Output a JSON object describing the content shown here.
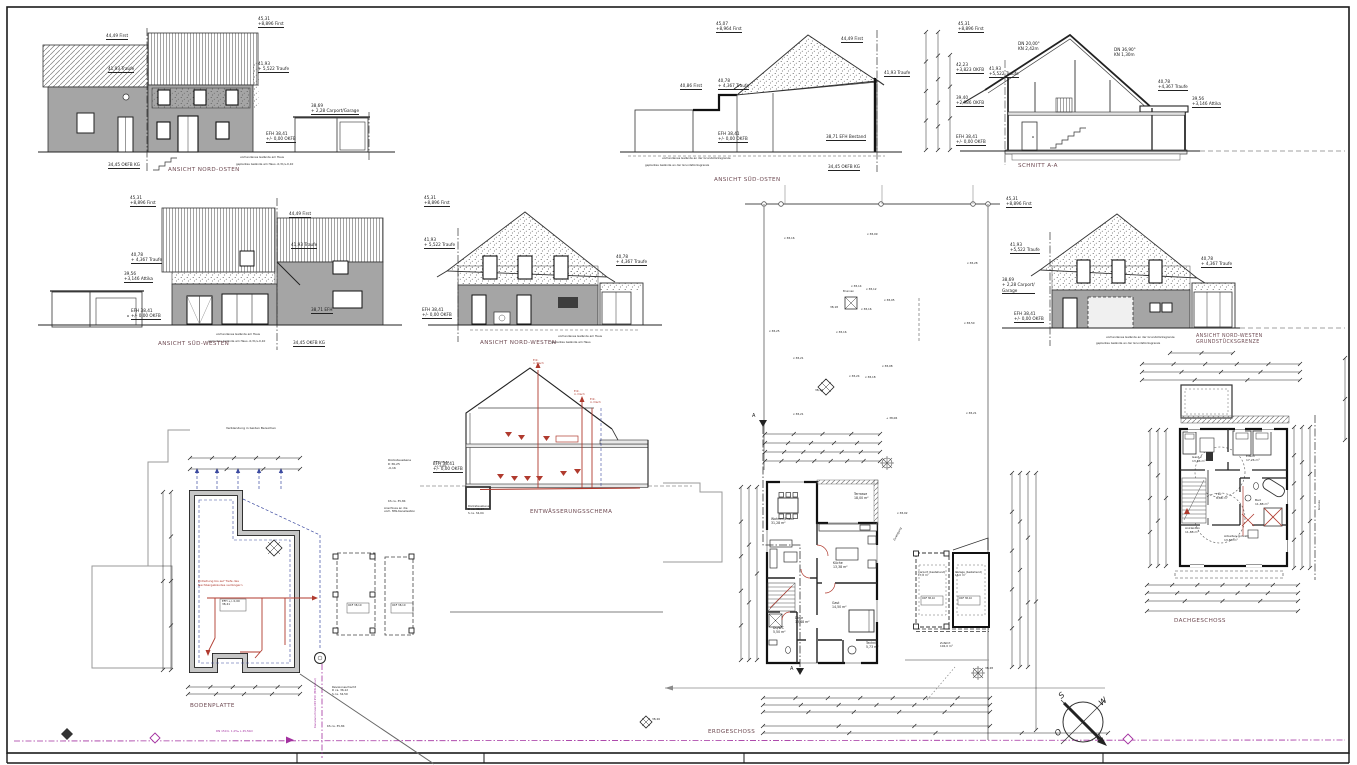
{
  "document": {
    "kind": "architectural-sheet",
    "language": "de"
  },
  "colors": {
    "wall_gray": "#a5a5a5",
    "line": "#222222",
    "drainage_red": "#b03a2e",
    "utility_magenta": "#a331a0",
    "guide_blue": "#3c4aa0",
    "boundary_gray": "#9a9a9a",
    "title_maroon": "#6e4a52"
  },
  "compass": {
    "s_label": "S",
    "w_label": "W",
    "o_label": "O",
    "n_label": "N"
  },
  "drawings": {
    "nord_osten": {
      "title": "ANSICHT NORD-OSTEN",
      "labels": [
        {
          "t": "44,49 First",
          "x": 106,
          "y": 33,
          "lv": 1
        },
        {
          "t": "41,93 Traufe",
          "x": 108,
          "y": 66,
          "lv": 1
        },
        {
          "t": "45,31\n+8,896 First",
          "x": 258,
          "y": 16,
          "lv": 1
        },
        {
          "t": "41,93\n+ 5,522 Traufe",
          "x": 258,
          "y": 61,
          "lv": 1
        },
        {
          "t": "38,69\n+ 2,28 Carport/Garage",
          "x": 311,
          "y": 103,
          "lv": 1
        },
        {
          "t": "EFH 38,41\n+/- 0,00 OKFB",
          "x": 266,
          "y": 131,
          "lv": 1
        },
        {
          "t": "34,45 OKFB KG",
          "x": 108,
          "y": 162,
          "lv": 1
        },
        {
          "t": "vorhandenes Gelände am Haus",
          "x": 240,
          "y": 156,
          "s": 2.8
        },
        {
          "t": "geplantes Gelände am Haus -0,31/+0,10",
          "x": 236,
          "y": 163,
          "s": 2.8
        }
      ]
    },
    "sued_osten": {
      "title": "ANSICHT SÜD-OSTEN",
      "labels": [
        {
          "t": "45,07\n+8,964 First",
          "x": 716,
          "y": 21,
          "lv": 1
        },
        {
          "t": "44,49 First",
          "x": 841,
          "y": 36,
          "lv": 1
        },
        {
          "t": "41,93 Traufe",
          "x": 884,
          "y": 70,
          "lv": 1
        },
        {
          "t": "40,86 First",
          "x": 680,
          "y": 83,
          "lv": 1
        },
        {
          "t": "40,78\n+ 4,367 Traufe",
          "x": 718,
          "y": 78,
          "lv": 1
        },
        {
          "t": "EFH 38,41\n+/- 0,00 OKFB",
          "x": 718,
          "y": 131,
          "lv": 1
        },
        {
          "t": "38,71 EFH Bestand",
          "x": 826,
          "y": 134,
          "lv": 1
        },
        {
          "t": "34,45 OKFB KG",
          "x": 828,
          "y": 164,
          "lv": 1
        },
        {
          "t": "vorhandenes Gelände an der Grundstücksgrenze",
          "x": 662,
          "y": 157,
          "s": 2.8
        },
        {
          "t": "geplantes Gelände an der Grundstücksgrenze",
          "x": 645,
          "y": 164,
          "s": 2.8
        }
      ]
    },
    "schnitt": {
      "title": "SCHNITT A-A",
      "labels": [
        {
          "t": "45,31\n+8,896 First",
          "x": 958,
          "y": 21,
          "lv": 1
        },
        {
          "t": "DN 20,00°\nKN 2,42m",
          "x": 1018,
          "y": 41
        },
        {
          "t": "DN 36,90°\nKN 1,30m",
          "x": 1114,
          "y": 47
        },
        {
          "t": "42,23\n+3,823 OKFB",
          "x": 956,
          "y": 62,
          "lv": 1
        },
        {
          "t": "41,93\n+5,522 Traufe",
          "x": 989,
          "y": 66,
          "lv": 1
        },
        {
          "t": "40,78\n+4,367 Traufe",
          "x": 1158,
          "y": 79,
          "lv": 1
        },
        {
          "t": "39,40\n+2,986 OKFB",
          "x": 956,
          "y": 95,
          "lv": 1
        },
        {
          "t": "39,56\n+3,146 Attika",
          "x": 1192,
          "y": 96,
          "lv": 1
        },
        {
          "t": "EFH 38,41\n+/- 0,00 OKFB",
          "x": 956,
          "y": 134,
          "lv": 1
        }
      ]
    },
    "sued_westen": {
      "title": "ANSICHT SÜD-WESTEN",
      "labels": [
        {
          "t": "45,31\n+8,896 First",
          "x": 130,
          "y": 195,
          "lv": 1
        },
        {
          "t": "44,49 First",
          "x": 289,
          "y": 211,
          "lv": 1
        },
        {
          "t": "41,93 Traufe",
          "x": 291,
          "y": 242,
          "lv": 1
        },
        {
          "t": "40,78\n+ 4,367 Traufe",
          "x": 131,
          "y": 252,
          "lv": 1
        },
        {
          "t": "39,56\n+3,146 Attika",
          "x": 124,
          "y": 271,
          "lv": 1
        },
        {
          "t": "EFH 38,41\n+/- 0,00 OKFB",
          "x": 131,
          "y": 308,
          "lv": 1
        },
        {
          "t": "38,71 EFH",
          "x": 311,
          "y": 307,
          "lv": 1
        },
        {
          "t": "34,45 OKFB KG",
          "x": 293,
          "y": 340,
          "lv": 1
        },
        {
          "t": "vorhandenes Gelände am Haus",
          "x": 216,
          "y": 333,
          "s": 2.8
        },
        {
          "t": "geplantes Gelände am Haus -0,31/+0,10",
          "x": 208,
          "y": 340,
          "s": 2.8
        }
      ]
    },
    "nord_westen": {
      "title": "ANSICHT NORD-WESTEN",
      "labels": [
        {
          "t": "45,31\n+8,896 First",
          "x": 424,
          "y": 195,
          "lv": 1
        },
        {
          "t": "41,93\n+ 5,522 Traufe",
          "x": 424,
          "y": 237,
          "lv": 1
        },
        {
          "t": "40,78\n+ 4,367 Traufe",
          "x": 616,
          "y": 254,
          "lv": 1
        },
        {
          "t": "EFH 38,41\n+/- 0,00 OKFB",
          "x": 422,
          "y": 307,
          "lv": 1
        },
        {
          "t": "vorhandenes Gelände am Haus",
          "x": 558,
          "y": 335,
          "s": 2.8
        },
        {
          "t": "geplantes Gelände am Haus",
          "x": 551,
          "y": 341,
          "s": 2.8
        }
      ]
    },
    "nord_westen_grenze": {
      "title": "ANSICHT NORD-WESTEN\nGRUNDSTÜCKSGRENZE",
      "labels": [
        {
          "t": "45,31\n+8,896 First",
          "x": 1006,
          "y": 196,
          "lv": 1
        },
        {
          "t": "41,93\n+5,522 Traufe",
          "x": 1010,
          "y": 242,
          "lv": 1
        },
        {
          "t": "38,69\n+ 2,28 Carport/\nGarage",
          "x": 1002,
          "y": 277,
          "lv": 1
        },
        {
          "t": "EFH 38,41\n+/- 0,00 OKFB",
          "x": 1014,
          "y": 311,
          "lv": 1
        },
        {
          "t": "40,78\n+ 4,367 Traufe",
          "x": 1201,
          "y": 256,
          "lv": 1
        },
        {
          "t": "vorhandenes Gelände an der Grundstücksgrenze",
          "x": 1106,
          "y": 336,
          "s": 2.8
        },
        {
          "t": "geplantes Gelände an der Grundstücksgrenze",
          "x": 1096,
          "y": 342,
          "s": 2.8
        }
      ]
    },
    "bodenplatte": {
      "title": "BODENPLATTE",
      "labels": [
        {
          "t": "Verblendung in beiden Bereichen",
          "x": 226,
          "y": 427,
          "s": 3
        },
        {
          "t": "Rückstauebene\nD 36,25\n-0,16",
          "x": 388,
          "y": 459,
          "s": 3
        },
        {
          "t": "EFH 38,41\n+/- 0,00",
          "x": 434,
          "y": 461,
          "s": 3
        },
        {
          "t": "KS ca. 35,84",
          "x": 388,
          "y": 500,
          "s": 2.8
        },
        {
          "t": "Anschluss an die\nvorh. MW-Kanalisation",
          "x": 384,
          "y": 507,
          "s": 2.8
        },
        {
          "t": "Erdleitung bis auf Tiefe des\nNachbargebäudes verlängern",
          "x": 198,
          "y": 580,
          "s": 3,
          "c": "red"
        },
        {
          "t": "EFH +/- 0,00\n38,41",
          "x": 222,
          "y": 600,
          "s": 2.8
        },
        {
          "t": "OKF 38,10",
          "x": 348,
          "y": 604,
          "s": 2.6
        },
        {
          "t": "OKF 38,10",
          "x": 392,
          "y": 604,
          "s": 2.6
        },
        {
          "t": "Revisionsschacht\nD ca. 36,12\nS ca. 34,59",
          "x": 332,
          "y": 686,
          "s": 2.8
        },
        {
          "t": "DN 150 b. 1,0‰ L 45,50m",
          "x": 216,
          "y": 730,
          "s": 2.8,
          "c": "mag"
        },
        {
          "t": "KS ca. 35,84",
          "x": 327,
          "y": 725,
          "s": 2.8
        },
        {
          "t": "Kanalanschluss DN 150 (MW-Kanal)",
          "x": 314,
          "y": 728,
          "s": 2.8,
          "c": "mag",
          "r": -90
        }
      ]
    },
    "entwaesserung": {
      "title": "ENTWÄSSERUNGSSCHEMA",
      "labels": [
        {
          "t": "EFH 38,41\n+/- 0,00 OKFB",
          "x": 433,
          "y": 461,
          "lv": 1
        },
        {
          "t": "Ent.\nü. Dach",
          "x": 533,
          "y": 359,
          "s": 2.8,
          "c": "red"
        },
        {
          "t": "Ent.\nü. Dach",
          "x": 574,
          "y": 390,
          "s": 2.8,
          "c": "red"
        },
        {
          "t": "Ent.\nü. Dach",
          "x": 590,
          "y": 398,
          "s": 2.8,
          "c": "red"
        },
        {
          "t": "Rückstauebene\nD ca. 36,17\nS ca. 34,04",
          "x": 468,
          "y": 505,
          "s": 2.8
        }
      ]
    },
    "erdgeschoss": {
      "title": "ERDGESCHOSS",
      "labels": [
        {
          "t": "Wohnen/Essen\n31,28 m²",
          "x": 771,
          "y": 517,
          "s": 3.2
        },
        {
          "t": "Terrasse\n18,00 m²",
          "x": 854,
          "y": 492,
          "s": 3.2
        },
        {
          "t": "Küche\n13,38 m²",
          "x": 833,
          "y": 561,
          "s": 3.2
        },
        {
          "t": "Gast\n14,50 m²",
          "x": 832,
          "y": 601,
          "s": 3.2
        },
        {
          "t": "Diele\n13,48 m²",
          "x": 795,
          "y": 616,
          "s": 3.2
        },
        {
          "t": "Du/WC\n5,50 m²",
          "x": 773,
          "y": 626,
          "s": 3.2
        },
        {
          "t": "Technik\n5,73 m²",
          "x": 866,
          "y": 641,
          "s": 3.2
        },
        {
          "t": "Zuwegung",
          "x": 893,
          "y": 540,
          "s": 2.8,
          "r": -62
        },
        {
          "t": "Carport (bestehend)\n17,8 m²",
          "x": 918,
          "y": 571,
          "s": 2.7
        },
        {
          "t": "Garage (bestehend)\n18,0 m²",
          "x": 955,
          "y": 571,
          "s": 2.7
        },
        {
          "t": "OKF 38,10",
          "x": 922,
          "y": 597,
          "s": 2.5
        },
        {
          "t": "OKF 38,10",
          "x": 959,
          "y": 597,
          "s": 2.5
        },
        {
          "t": "Zufahrt\n102,0 m²",
          "x": 940,
          "y": 642,
          "s": 2.8
        },
        {
          "t": "A",
          "x": 790,
          "y": 666,
          "s": 5
        },
        {
          "t": "A",
          "x": 752,
          "y": 413,
          "s": 5
        }
      ]
    },
    "dachgeschoss": {
      "title": "DACHGESCHOSS",
      "labels": [
        {
          "t": "Gast 2\n13,86 m²",
          "x": 1192,
          "y": 456,
          "s": 3
        },
        {
          "t": "Eltern\n17,26 m²",
          "x": 1246,
          "y": 455,
          "s": 3
        },
        {
          "t": "Flur\n8,86 m²",
          "x": 1216,
          "y": 493,
          "s": 3
        },
        {
          "t": "Bad\n11,88 m²",
          "x": 1255,
          "y": 499,
          "s": 3
        },
        {
          "t": "Ankleiden\n11,88 m²",
          "x": 1185,
          "y": 527,
          "s": 3
        },
        {
          "t": "Arbeiten (privat)\n13,86 m²",
          "x": 1224,
          "y": 535,
          "s": 3
        },
        {
          "t": "Grenze",
          "x": 1318,
          "y": 510,
          "s": 2.8,
          "r": -90
        }
      ]
    }
  },
  "site": {
    "labels": [
      {
        "t": "x 38,16",
        "x": 784,
        "y": 237,
        "s": 2.8
      },
      {
        "t": "x 38,09",
        "x": 867,
        "y": 233,
        "s": 2.8
      },
      {
        "t": "x 38,28",
        "x": 967,
        "y": 262,
        "s": 2.8
      },
      {
        "t": "x 38,14",
        "x": 851,
        "y": 285,
        "s": 2.8
      },
      {
        "t": "x 38,12",
        "x": 866,
        "y": 288,
        "s": 2.8
      },
      {
        "t": "x 38,05",
        "x": 884,
        "y": 299,
        "s": 2.8
      },
      {
        "t": "Brunnen",
        "x": 843,
        "y": 290,
        "s": 2.6
      },
      {
        "t": "38,18",
        "x": 830,
        "y": 306,
        "s": 2.8
      },
      {
        "t": "x 38,16",
        "x": 861,
        "y": 308,
        "s": 2.8
      },
      {
        "t": "x 38,50",
        "x": 964,
        "y": 322,
        "s": 2.8
      },
      {
        "t": "x 38,25",
        "x": 769,
        "y": 330,
        "s": 2.8
      },
      {
        "t": "x 38,16",
        "x": 836,
        "y": 331,
        "s": 2.8
      },
      {
        "t": "x 38,21",
        "x": 793,
        "y": 357,
        "s": 2.8
      },
      {
        "t": "x 38,08",
        "x": 882,
        "y": 365,
        "s": 2.8
      },
      {
        "t": "x 38,24",
        "x": 849,
        "y": 375,
        "s": 2.8
      },
      {
        "t": "x 38,18",
        "x": 865,
        "y": 376,
        "s": 2.8
      },
      {
        "t": "38,24",
        "x": 815,
        "y": 389,
        "s": 2.8
      },
      {
        "t": "x 38,21",
        "x": 793,
        "y": 413,
        "s": 2.8
      },
      {
        "t": "+ 38,06",
        "x": 886,
        "y": 417,
        "s": 2.8
      },
      {
        "t": "x 38,21",
        "x": 966,
        "y": 412,
        "s": 2.8
      },
      {
        "t": "x 38,02",
        "x": 897,
        "y": 512,
        "s": 2.8
      },
      {
        "t": "38,28",
        "x": 985,
        "y": 667,
        "s": 2.8
      },
      {
        "t": "38,26",
        "x": 652,
        "y": 718,
        "s": 2.8
      }
    ]
  }
}
